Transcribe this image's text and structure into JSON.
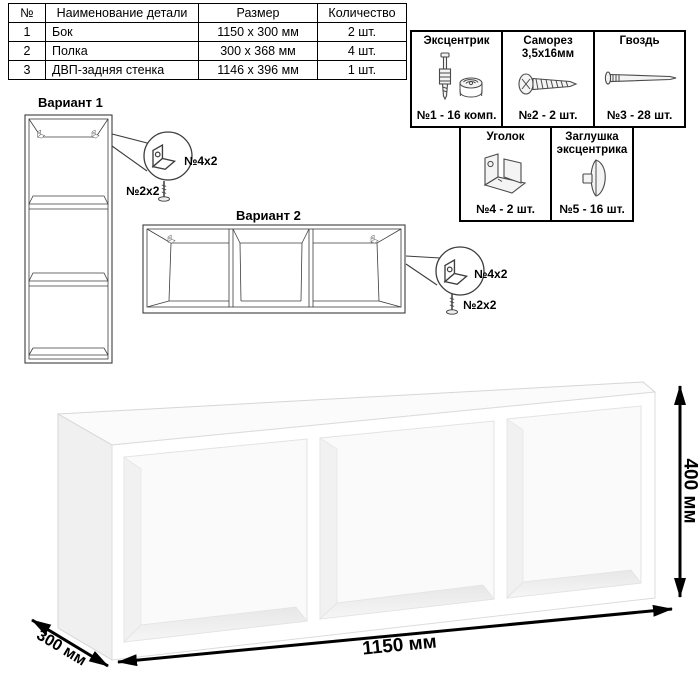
{
  "parts_table": {
    "headers": [
      "№",
      "Наименование детали",
      "Размер",
      "Количество"
    ],
    "rows": [
      {
        "num": "1",
        "name": "Бок",
        "size": "1150 x 300 мм",
        "qty": "2 шт."
      },
      {
        "num": "2",
        "name": "Полка",
        "size": "300 x 368 мм",
        "qty": "4 шт."
      },
      {
        "num": "3",
        "name": "ДВП-задняя стенка",
        "size": "1146 x 396 мм",
        "qty": "1 шт."
      }
    ]
  },
  "hardware": {
    "eccentric": {
      "name": "Эксцентрик",
      "qty": "№1 - 16 комп."
    },
    "screw": {
      "name": "Саморез 3,5х16мм",
      "qty": "№2 - 2 шт."
    },
    "nail": {
      "name": "Гвоздь",
      "qty": "№3 - 28 шт."
    },
    "bracket": {
      "name": "Уголок",
      "qty": "№4 - 2 шт."
    },
    "cap": {
      "name": "Заглушка эксцентрика",
      "qty": "№5 - 16 шт."
    }
  },
  "variant1": {
    "label": "Вариант 1",
    "bracket_label": "№4х2",
    "screw_label": "№2х2"
  },
  "variant2": {
    "label": "Вариант 2",
    "bracket_label": "№4х2",
    "screw_label": "№2х2"
  },
  "dimensions": {
    "width": "1150 мм",
    "height": "400 мм",
    "depth": "300 мм"
  },
  "colors": {
    "line": "#3d3d3d",
    "dimension": "#000000",
    "background": "#ffffff"
  }
}
